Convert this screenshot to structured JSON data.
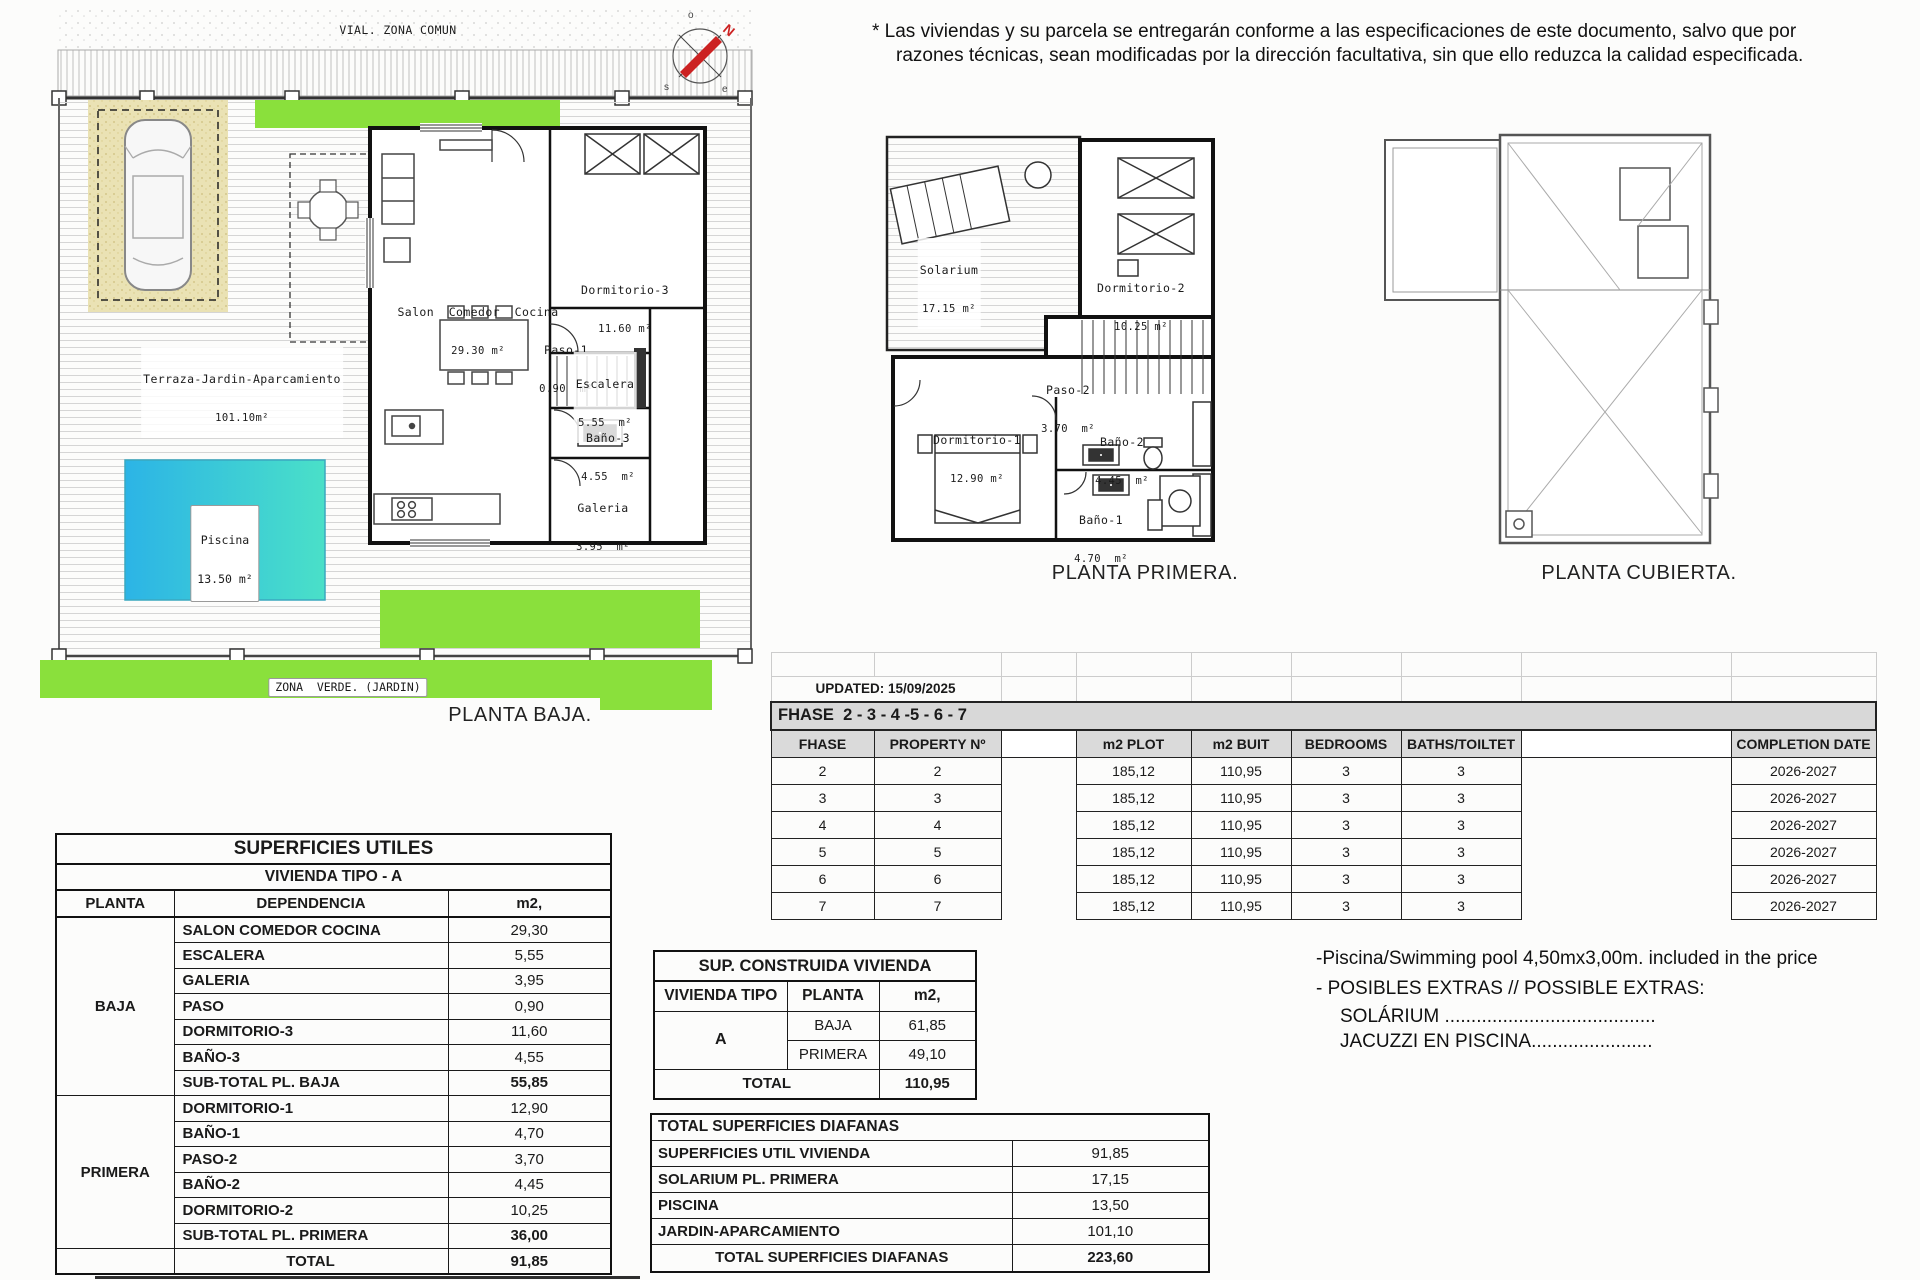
{
  "disclaimer": {
    "line1": "* Las viviendas y su parcela se entregarán conforme a las especificaciones de este documento, salvo que por",
    "line2": "razones técnicas, sean modificadas por la dirección facultativa, sin que ello reduzca la calidad especificada."
  },
  "compass": {
    "n": "N",
    "o": "o",
    "s": "s",
    "e": "e"
  },
  "plans": {
    "baja": {
      "title": "PLANTA BAJA.",
      "vial": "VIAL. ZONA COMUN",
      "zona_verde": "ZONA  VERDE. (JARDIN)",
      "terraza_name": "Terraza-Jardin-Aparcamiento",
      "terraza_area": "101.10m²",
      "piscina_name": "Piscina",
      "piscina_area": "13.50 m²",
      "rooms": [
        {
          "name": "Salon  Comedor  Cocina",
          "area": "29.30 m²"
        },
        {
          "name": "Dormitorio-3",
          "area": "11.60 m²"
        },
        {
          "name": "Paso-1",
          "area": "0.90  m²"
        },
        {
          "name": "Escalera",
          "area": "5.55  m²"
        },
        {
          "name": "Baño-3",
          "area": "4.55  m²"
        },
        {
          "name": "Galeria",
          "area": "3.95  m²"
        }
      ]
    },
    "primera": {
      "title": "PLANTA PRIMERA.",
      "rooms": [
        {
          "name": "Solarium",
          "area": "17.15 m²"
        },
        {
          "name": "Dormitorio-2",
          "area": "10.25 m²"
        },
        {
          "name": "Paso-2",
          "area": "3.70  m²"
        },
        {
          "name": "Dormitorio-1",
          "area": "12.90 m²"
        },
        {
          "name": "Baño-2",
          "area": "4.45  m²"
        },
        {
          "name": "Baño-1",
          "area": "4.70  m²"
        }
      ]
    },
    "cubierta": {
      "title": "PLANTA CUBIERTA."
    }
  },
  "phase_table": {
    "updated": "UPDATED: 15/09/2025",
    "band": "FHASE  2 - 3 - 4 -5 - 6 - 7",
    "headers": {
      "fhase": "FHASE",
      "property": "PROPERTY Nº",
      "plot": "m2 PLOT",
      "built": "m2 BUIT",
      "bedrooms": "BEDROOMS",
      "baths": "BATHS/TOILTET",
      "completion": "COMPLETION DATE"
    },
    "rows": [
      {
        "fhase": "2",
        "property": "2",
        "plot": "185,12",
        "built": "110,95",
        "bedrooms": "3",
        "baths": "3",
        "completion": "2026-2027"
      },
      {
        "fhase": "3",
        "property": "3",
        "plot": "185,12",
        "built": "110,95",
        "bedrooms": "3",
        "baths": "3",
        "completion": "2026-2027"
      },
      {
        "fhase": "4",
        "property": "4",
        "plot": "185,12",
        "built": "110,95",
        "bedrooms": "3",
        "baths": "3",
        "completion": "2026-2027"
      },
      {
        "fhase": "5",
        "property": "5",
        "plot": "185,12",
        "built": "110,95",
        "bedrooms": "3",
        "baths": "3",
        "completion": "2026-2027"
      },
      {
        "fhase": "6",
        "property": "6",
        "plot": "185,12",
        "built": "110,95",
        "bedrooms": "3",
        "baths": "3",
        "completion": "2026-2027"
      },
      {
        "fhase": "7",
        "property": "7",
        "plot": "185,12",
        "built": "110,95",
        "bedrooms": "3",
        "baths": "3",
        "completion": "2026-2027"
      }
    ]
  },
  "superficies_utiles": {
    "title": "SUPERFICIES UTILES",
    "subtitle": "VIVIENDA TIPO - A",
    "headers": {
      "planta": "PLANTA",
      "dep": "DEPENDENCIA",
      "m2": "m2,"
    },
    "baja_label": "BAJA",
    "primera_label": "PRIMERA",
    "baja_rows": [
      {
        "dep": "SALON COMEDOR COCINA",
        "m2": "29,30"
      },
      {
        "dep": "ESCALERA",
        "m2": "5,55"
      },
      {
        "dep": "GALERIA",
        "m2": "3,95"
      },
      {
        "dep": "PASO",
        "m2": "0,90"
      },
      {
        "dep": "DORMITORIO-3",
        "m2": "11,60"
      },
      {
        "dep": "BAÑO-3",
        "m2": "4,55"
      }
    ],
    "baja_subtotal": {
      "dep": "SUB-TOTAL PL. BAJA",
      "m2": "55,85"
    },
    "primera_rows": [
      {
        "dep": "DORMITORIO-1",
        "m2": "12,90"
      },
      {
        "dep": "BAÑO-1",
        "m2": "4,70"
      },
      {
        "dep": "PASO-2",
        "m2": "3,70"
      },
      {
        "dep": "BAÑO-2",
        "m2": "4,45"
      },
      {
        "dep": "DORMITORIO-2",
        "m2": "10,25"
      }
    ],
    "primera_subtotal": {
      "dep": "SUB-TOTAL PL. PRIMERA",
      "m2": "36,00"
    },
    "total": {
      "dep": "TOTAL",
      "m2": "91,85"
    }
  },
  "sup_construida": {
    "title": "SUP. CONSTRUIDA VIVIENDA",
    "headers": {
      "tipo": "VIVIENDA TIPO",
      "planta": "PLANTA",
      "m2": "m2,"
    },
    "tipo": "A",
    "rows": [
      {
        "planta": "BAJA",
        "m2": "61,85"
      },
      {
        "planta": "PRIMERA",
        "m2": "49,10"
      }
    ],
    "total_label": "TOTAL",
    "total_value": "110,95"
  },
  "diafanas": {
    "title": "TOTAL SUPERFICIES DIAFANAS",
    "rows": [
      {
        "label": "SUPERFICIES UTIL VIVIENDA",
        "value": "91,85"
      },
      {
        "label": "SOLARIUM PL. PRIMERA",
        "value": "17,15"
      },
      {
        "label": "PISCINA",
        "value": "13,50"
      },
      {
        "label": "JARDIN-APARCAMIENTO",
        "value": "101,10"
      }
    ],
    "total_label": "TOTAL SUPERFICIES DIAFANAS",
    "total_value": "223,60"
  },
  "notes": {
    "pool": "-Piscina/Swimming pool 4,50mx3,00m. included in the price",
    "extras": "- POSIBLES EXTRAS // POSSIBLE EXTRAS:",
    "extra_solarium": "SOLÁRIUM ........................................",
    "extra_jacuzzi": "JACUZZI EN PISCINA......................."
  },
  "colors": {
    "green": "#8ae03c",
    "pool_start": "#2cb4e6",
    "pool_end": "#4ae0c8",
    "parking": "#eae2b4",
    "table_gray": "#d8d8d8"
  }
}
